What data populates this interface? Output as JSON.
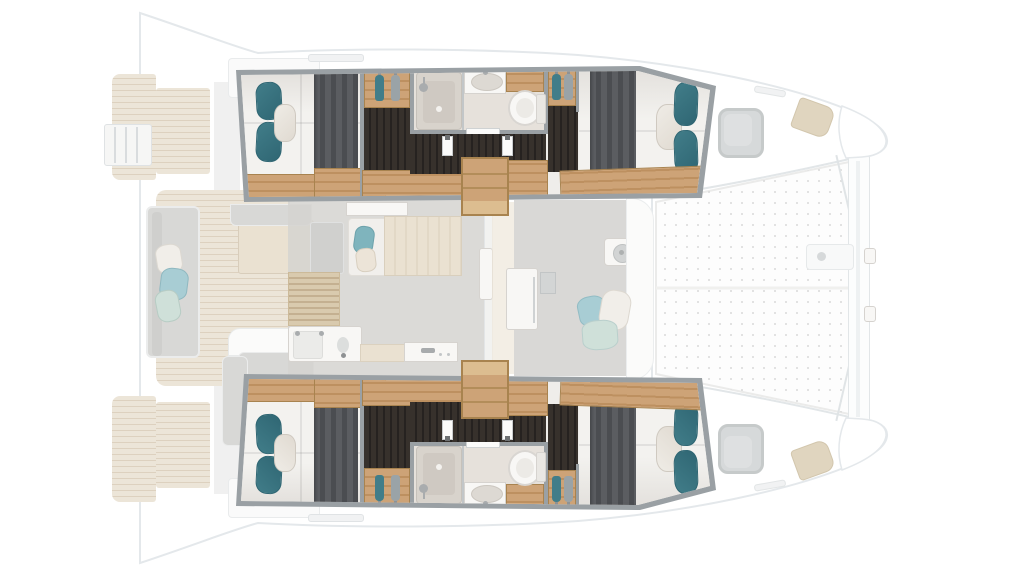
{
  "vessel": {
    "type": "catamaran sailing yacht",
    "view": "overhead interior floor plan, bow pointing right",
    "cabins": 4,
    "bathrooms": 2,
    "double_berths": 4,
    "companionway_stairs": 2,
    "trampoline": true,
    "swim_platforms": 2,
    "deck_hatches": 2
  },
  "regions": {
    "port_hull": [
      "aft-cabin",
      "bathroom",
      "corridor",
      "forward-cabin"
    ],
    "starboard_hull": [
      "aft-cabin",
      "bathroom",
      "corridor",
      "forward-cabin"
    ],
    "bridgedeck": [
      "aft-cockpit",
      "salon-galley",
      "forward-cockpit",
      "trampoline",
      "forward-beam"
    ]
  },
  "icons": [
    "shower-head-icon",
    "toilet-icon",
    "sink-icon",
    "clothes-hanger-icon",
    "boarding-ladder-icon",
    "windlass-icon",
    "cooktop-icon"
  ],
  "palette": {
    "wall": "#9aa0a4",
    "wood": "#cda377",
    "woodGrain": "#bd9060",
    "woodEdge": "#a8834f",
    "darkFloor": "#37312c",
    "darkStreak": "#262220",
    "linen": "#f3f2ef",
    "linenShade": "#e3e0dc",
    "blanket": "#5b5d61",
    "blanketStripe": "#4b4d51",
    "teal": "#417d89",
    "tealDk": "#2f6673",
    "pillowCream": "#e0dad1",
    "bathFloor": "#e6e1db",
    "showerTray": "#d8d3cc",
    "showerInner": "#cfc9c2",
    "white": "#f8f7f5",
    "fixtureEdge": "#d6d3cf",
    "metal": "#a9acae",
    "teak": "#ece5d8",
    "teakLine": "#ddd1bf",
    "sofa": "#d8d8d6",
    "sofaEdge": "#ebecec",
    "pTeal": "#a8cdd4",
    "pMint": "#cfe0d9",
    "pWhite": "#f1eee9",
    "salonFloor": "#d5d3d0",
    "beigeWood": "#eae1d1",
    "louver": "#d9c8a8",
    "louverLine": "#c0a985",
    "grayFloor": "#d2d1cf",
    "hullStroke": "#e4e8eb",
    "hullFill": "#ffffff",
    "hatch": "#cdd0d1",
    "hatchEdge": "#b9bdbe",
    "hatchIn": "#d7d9da",
    "locker": "#dbceb4",
    "dot": "#dcdcdc",
    "glass": "#c2c6c8",
    "doorJamb": "#6e7173"
  }
}
